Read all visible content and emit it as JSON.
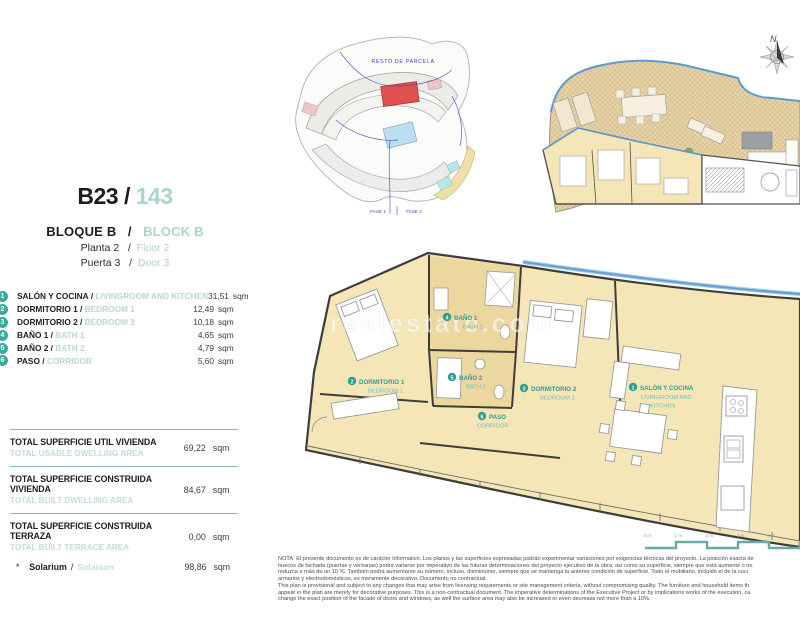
{
  "header": {
    "unit_code": "B23",
    "sep": "/",
    "unit_number": "143",
    "block_es": "BLOQUE B",
    "block_en": "BLOCK B",
    "floor_es": "Planta 2",
    "floor_en": "Floor 2",
    "door_es": "Puerta 3",
    "door_en": "Door 3"
  },
  "rooms": [
    {
      "num": "1",
      "name_es": "SALÓN Y COCINA",
      "name_en": "LIVINGROOM AND KITCHEN",
      "area": "31,51",
      "unit": "sqm"
    },
    {
      "num": "2",
      "name_es": "DORMITORIO 1",
      "name_en": "BEDROOM 1",
      "area": "12,49",
      "unit": "sqm"
    },
    {
      "num": "3",
      "name_es": "DORMITORIO 2",
      "name_en": "BEDROOM 2",
      "area": "10,18",
      "unit": "sqm"
    },
    {
      "num": "4",
      "name_es": "BAÑO 1",
      "name_en": "BATH 1",
      "area": "4,65",
      "unit": "sqm"
    },
    {
      "num": "5",
      "name_es": "BAÑO 2",
      "name_en": "BATH 2",
      "area": "4,79",
      "unit": "sqm"
    },
    {
      "num": "6",
      "name_es": "PASO",
      "name_en": "CORRIDOR",
      "area": "5,60",
      "unit": "sqm"
    }
  ],
  "totals": [
    {
      "label_es": "TOTAL SUPERFICIE UTIL VIVIENDA",
      "label_en": "TOTAL USABLE DWELLING AREA",
      "value": "69,22",
      "unit": "sqm"
    },
    {
      "label_es": "TOTAL SUPERFICIE CONSTRUIDA VIVIENDA",
      "label_en": "TOTAL BUILT DWELLING AREA",
      "value": "84,67",
      "unit": "sqm"
    },
    {
      "label_es": "TOTAL SUPERFICIE CONSTRUIDA TERRAZA",
      "label_en": "TOTAL BUILT TERRACE AREA",
      "value": "0,00",
      "unit": "sqm"
    }
  ],
  "solarium": {
    "bullet": "*",
    "label_es": "Solarium",
    "sep": "/",
    "label_en": "Solarium",
    "value": "98,86",
    "unit": "sqm"
  },
  "site_plan": {
    "resto_label": "RESTO DE PARCELA",
    "fase1": "FASE 1",
    "fase2": "FASE 2"
  },
  "compass": {
    "north": "N"
  },
  "plan_labels": {
    "salon": {
      "num": "1",
      "es": "SALÓN Y COCINA",
      "en1": "LIVINGROOM AND",
      "en2": "KITCHEN"
    },
    "dorm1": {
      "num": "2",
      "es": "DORMITORIO 1",
      "en": "BEDROOM 1"
    },
    "dorm2": {
      "num": "3",
      "es": "DORMITORIO 2",
      "en": "BEDROOM 2"
    },
    "bath1": {
      "num": "4",
      "es": "BAÑO 1",
      "en": "BATH 1"
    },
    "bath2": {
      "num": "5",
      "es": "BAÑO 2",
      "en": "BATH 2"
    },
    "paso": {
      "num": "6",
      "es": "PASO",
      "en": "CORRIDOR"
    }
  },
  "scale_bar": {
    "ticks": [
      "0 m.",
      "1 m.",
      "2 m.",
      "3 m.",
      "4 m."
    ]
  },
  "watermark": "realestate.com",
  "disclaimer": {
    "lines": [
      "NOTA: El presente documento es de carácter informativo. Los planos y las superficies expresadas podrán experimentar variaciones por exigencias técnicas del proyecto. La posición exacta de",
      "huecos de fachada (puertas y ventanas) podrá variarse por imperativo de las futuras determinaciones del proyecto ejecutivo de la obra, así como su superficie, siempre que está aumente o no",
      "reduzca e más de un 10 %. También podrá aumentarse su número, incluso, disminuirse, siempre que se mantenga la anterior condición de superficie. Todo el mobiliario, incluido el de la coci",
      "armarios y electrodomésticos, es meramente decorativo. Documento no contractual.",
      "This plan is provisional and subject to any changes that may arise from licensing requirements or site management criteria, without compromising quality. The furniture and household items th",
      "appear in the plan are merely for decorative purposes. This is a non-contractual document. The imperative determinations of the Executive Project or by implications works of the execution, ca",
      "change the exact position of the facade of doors and windows, as well the surface area may also be increased or even decrease not more than a 10%."
    ]
  },
  "colors": {
    "accent_teal": "#3fa89e",
    "light_teal": "#a9d4ce",
    "plan_yellow": "#f5e6b8",
    "bath_tan": "#ecd79e",
    "highlight_red": "#e2504e",
    "line_blue": "#3a49c0",
    "glass_blue": "#5b9bd0"
  }
}
